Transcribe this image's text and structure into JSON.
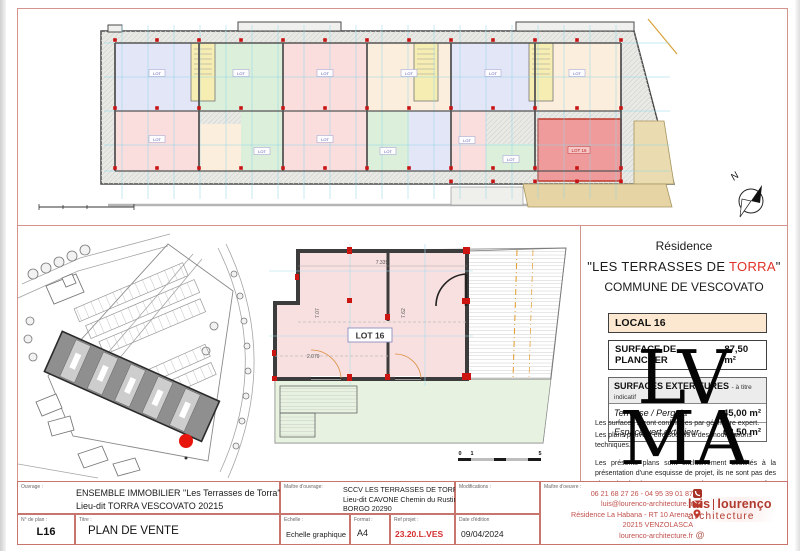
{
  "colors": {
    "frame_red": "#d4948d",
    "accent_red": "#e03228",
    "logo_red": "#b03a2e",
    "lot_highlight_fill": "#f09b9b",
    "pastel_blue": "#e3e6f7",
    "pastel_green": "#dcefdb",
    "pastel_pink": "#f9dedd",
    "pastel_cream": "#fbeedd",
    "stair_yellow": "#f6edb2",
    "terrace_tan": "#eadbb0"
  },
  "top_plan": {
    "north_label": "N",
    "lot_labels": [
      {
        "text": "LOT",
        "x": 139,
        "y": 64
      },
      {
        "text": "LOT",
        "x": 223,
        "y": 64
      },
      {
        "text": "LOT",
        "x": 307,
        "y": 64
      },
      {
        "text": "LOT",
        "x": 391,
        "y": 64
      },
      {
        "text": "LOT",
        "x": 475,
        "y": 64
      },
      {
        "text": "LOT",
        "x": 559,
        "y": 64
      },
      {
        "text": "LOT",
        "x": 139,
        "y": 130
      },
      {
        "text": "LOT",
        "x": 244,
        "y": 142
      },
      {
        "text": "LOT",
        "x": 307,
        "y": 130
      },
      {
        "text": "LOT",
        "x": 370,
        "y": 142
      },
      {
        "text": "LOT",
        "x": 449,
        "y": 131
      },
      {
        "text": "LOT",
        "x": 493,
        "y": 150
      },
      {
        "text": "LOT 16",
        "x": 561,
        "y": 141,
        "red": true
      }
    ]
  },
  "site_plan": {},
  "detail_plan": {
    "lot_label": "LOT 16",
    "dim_top": "7.339",
    "dim_left": "2.079",
    "dim_v1": "7.07",
    "dim_v2": "7.62",
    "scale_ticks": [
      "0",
      "1",
      "5"
    ]
  },
  "info": {
    "residence": "Résidence",
    "name_pre": "\"LES TERRASSES DE ",
    "name_red": "TORRA",
    "name_post": "\"",
    "commune": "COMMUNE DE VESCOVATO",
    "local_header": "LOCAL 16",
    "plancher_label": "SURFACE DE PLANCHER",
    "plancher_value": "87,50 m²",
    "ext_header": "SURFACES EXTERIEURES",
    "ext_note": "- à titre indicatif",
    "ext_rows": [
      {
        "label": "Terrasse / Pergola",
        "value": "45,00 m²"
      },
      {
        "label": "Espace vert extérieur",
        "value": "68,50 m²"
      }
    ],
    "notes": [
      "Les surfaces seront confirmées par géomètre expert.",
      "Les plans peuvent être soumis à des modifications techniques.",
      "Les présents plans sont exclusivement destinés à la présentation d'une esquisse de projet, ils ne sont pas des plans d'exécution et ne peuvent donc en aucun cas être directement utilisés pour réaliser la construction."
    ],
    "watermark": [
      "LV",
      "MA"
    ]
  },
  "tb": {
    "ouvrage_label": "Ouvrage :",
    "ouvrage_line1": "ENSEMBLE IMMOBILIER \"Les Terrasses de Torra\"",
    "ouvrage_line2": "Lieu-dit TORRA VESCOVATO 20215",
    "moa_label": "Maître d'ouvrage:",
    "moa_line1": "SCCV LES TERRASSES DE TORRA",
    "moa_line2": "Lieu-dit CAVONE Chemin du Rustinchetto",
    "moa_line3": "BORGO 20290",
    "modif_label": "Modifications :",
    "moe_label": "Maître d'oeuvre :",
    "nplan_label": "N° de plan :",
    "nplan": "L16",
    "titre_label": "Titre :",
    "titre": "PLAN DE VENTE",
    "echelle_label": "Echelle :",
    "echelle": "Echelle graphique",
    "format_label": "Format :",
    "format": "A4",
    "ref_label": "Ref projet :",
    "ref": "23.20.L.VES",
    "date_label": "Date d'édition",
    "date": "09/04/2024",
    "contact": {
      "phone": "06 21 68 27 26 - 04 95 39 01 87",
      "email": "luis@lourenco-architecture.fr",
      "address1": "Résidence La Habana - RT 10 Arena -",
      "address2": "20215 VENZOLASCA",
      "web": "lourenco-architecture.fr"
    },
    "logo_l1a": "luis",
    "logo_l1b": "lourenço",
    "logo_l2": "architecture"
  }
}
